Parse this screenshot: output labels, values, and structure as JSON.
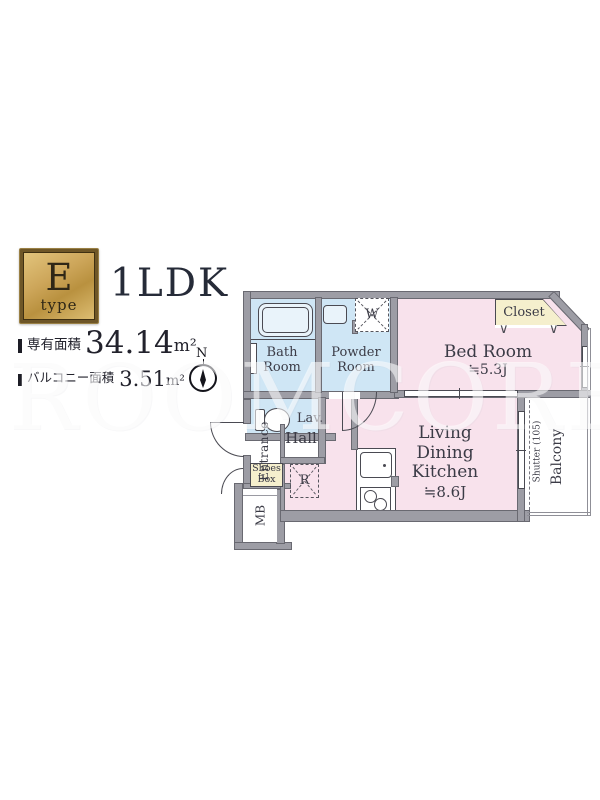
{
  "badge": {
    "letter": "E",
    "sub": "type"
  },
  "title": "1LDK",
  "areas": {
    "exclusive": {
      "label": "専有面積",
      "value": "34.14",
      "unit": "m²"
    },
    "balcony": {
      "label": "バルコニー面積",
      "value": "3.51",
      "unit": "m²"
    }
  },
  "compass": {
    "label": "N"
  },
  "rooms": {
    "bath": {
      "label": "Bath Room"
    },
    "powder": {
      "label": "Powder Room"
    },
    "washer": {
      "label": "W"
    },
    "closet": {
      "label": "Closet"
    },
    "bedroom": {
      "label": "Bed Room",
      "size": "≒5.3J"
    },
    "lavatory": {
      "label": "Lav."
    },
    "hall": {
      "label": "Hall"
    },
    "entrance": {
      "label": "Entrance"
    },
    "shoes_box": {
      "label": "Shoes Box"
    },
    "meter_box": {
      "label": "MB"
    },
    "refrigerator": {
      "label": "R"
    },
    "ldk": {
      "label": "Living Dining Kitchen",
      "size": "≒8.6J"
    },
    "shutter": {
      "label": "Shutter (105)"
    },
    "balcony": {
      "label": "Balcony"
    }
  },
  "icons": {
    "folding_door_mark": "∨"
  },
  "watermark": "ROOMCORE",
  "colors": {
    "wall": "#9d9da5",
    "wet_room": "#cfe6f5",
    "main_room": "#f8e2ec",
    "storage": "#f5efcd",
    "badge_gold": "#c8a152",
    "text": "#3b3b46"
  }
}
